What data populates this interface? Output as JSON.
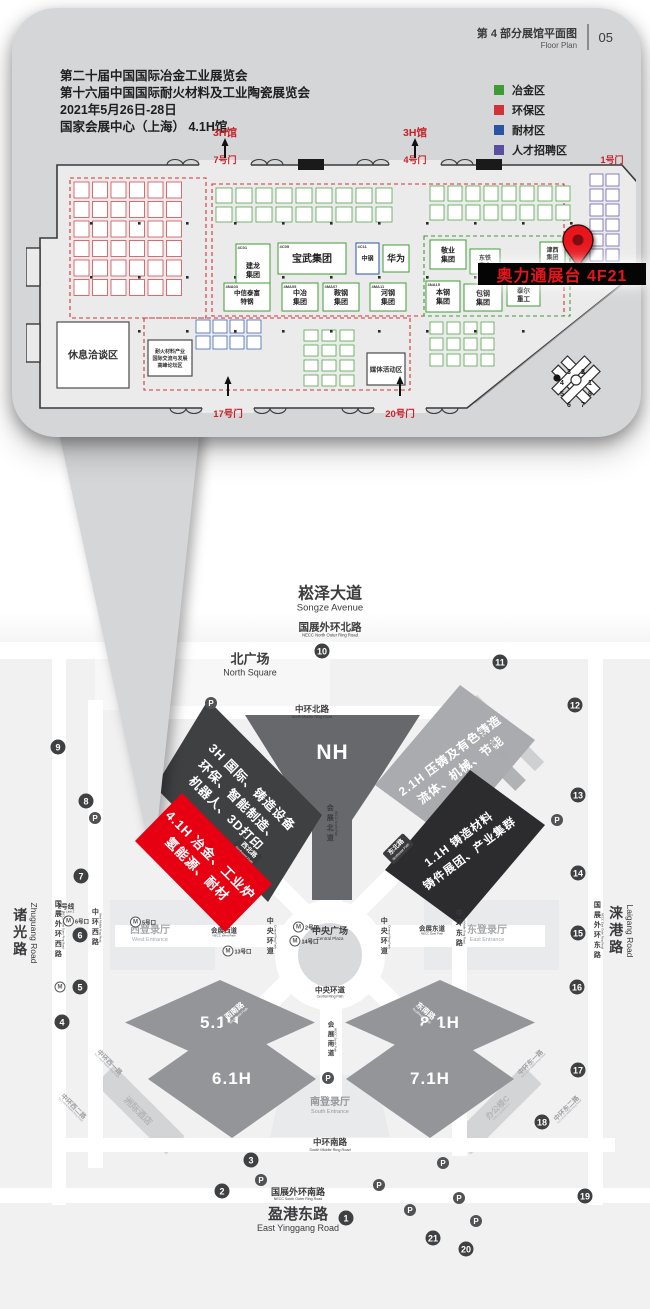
{
  "callout": {
    "header": {
      "title_zh": "第 4 部分展馆平面图",
      "title_en": "Floor Plan",
      "page_no": "05"
    },
    "info_lines": [
      "第二十届中国国际冶金工业展览会",
      "第十六届中国国际耐火材料及工业陶瓷展览会",
      "2021年5月26日-28日",
      "国家会展中心（上海） 4.1H馆"
    ],
    "legend": [
      {
        "label": "冶金区",
        "key": "green"
      },
      {
        "label": "环保区",
        "key": "red"
      },
      {
        "label": "耐材区",
        "key": "blue"
      },
      {
        "label": "人才招聘区",
        "key": "purple"
      }
    ],
    "zone_colors": {
      "green": "#3f9c35",
      "red": "#cf3339",
      "blue": "#2a55a5",
      "purple": "#5b4ea0"
    },
    "floorplan": {
      "marker_label": "奥力通展台 4F21",
      "compass_numbers": [
        "3",
        "2",
        "4",
        "1",
        "5",
        "8",
        "6",
        "7"
      ],
      "gates_top": [
        {
          "hall_label": "3H馆",
          "gate": "7号门",
          "x": 199
        },
        {
          "hall_label": "3H馆",
          "gate": "4号门",
          "x": 389
        },
        {
          "hall_label": "",
          "gate": "1号门",
          "x": 586,
          "plain": true
        }
      ],
      "gates_bottom": [
        {
          "gate": "17号门",
          "x": 202
        },
        {
          "gate": "20号门",
          "x": 374
        }
      ],
      "zones": [
        {
          "x": 44,
          "y": 52,
          "w": 136,
          "h": 140,
          "c": "red"
        },
        {
          "x": 186,
          "y": 58,
          "w": 352,
          "h": 132,
          "c": "red"
        },
        {
          "x": 118,
          "y": 192,
          "w": 266,
          "h": 72,
          "c": "red"
        },
        {
          "x": 398,
          "y": 110,
          "w": 146,
          "h": 80,
          "c": "green"
        }
      ],
      "grids": [
        {
          "x": 48,
          "y": 56,
          "cols": 6,
          "rows": 6,
          "cw": 15,
          "ch": 16,
          "g": 3.5,
          "c": "red"
        },
        {
          "x": 190,
          "y": 62,
          "cols": 9,
          "rows": 2,
          "cw": 16,
          "ch": 15,
          "g": 4,
          "c": "green"
        },
        {
          "x": 404,
          "y": 60,
          "cols": 8,
          "rows": 2,
          "cw": 14,
          "ch": 15,
          "g": 4,
          "c": "green"
        },
        {
          "x": 170,
          "y": 194,
          "cols": 4,
          "rows": 2,
          "cw": 14,
          "ch": 13,
          "g": 3,
          "c": "blue"
        },
        {
          "x": 278,
          "y": 204,
          "cols": 3,
          "rows": 4,
          "cw": 14,
          "ch": 11,
          "g": 4,
          "c": "green"
        },
        {
          "x": 404,
          "y": 196,
          "cols": 4,
          "rows": 3,
          "cw": 13,
          "ch": 12,
          "g": 4,
          "c": "green"
        },
        {
          "x": 564,
          "y": 48,
          "cols": 2,
          "rows": 6,
          "cw": 13,
          "ch": 12,
          "g": 3,
          "c": "purple"
        }
      ],
      "booths": [
        {
          "id": "4C01",
          "lines": [
            "建龙",
            "集团"
          ],
          "x": 210,
          "y": 118,
          "w": 34,
          "h": 52,
          "fs": 7,
          "c": "green"
        },
        {
          "id": "4C05",
          "lines": [
            "宝武集团"
          ],
          "x": 252,
          "y": 117,
          "w": 68,
          "h": 31,
          "fs": 10,
          "c": "green"
        },
        {
          "id": "4C11",
          "lines": [
            "中钢"
          ],
          "x": 330,
          "y": 117,
          "w": 23,
          "h": 31,
          "fs": 6,
          "c": "blue"
        },
        {
          "lines": [
            "华为"
          ],
          "x": 357,
          "y": 119,
          "w": 26,
          "h": 27,
          "fs": 9,
          "c": "green"
        },
        {
          "id": "4NA03",
          "lines": [
            "中信泰富",
            "特钢"
          ],
          "x": 198,
          "y": 157,
          "w": 46,
          "h": 28,
          "fs": 6.5,
          "c": "green"
        },
        {
          "id": "4MA05",
          "lines": [
            "中冶",
            "集团"
          ],
          "x": 256,
          "y": 157,
          "w": 36,
          "h": 28,
          "fs": 7,
          "c": "green"
        },
        {
          "id": "4MA07",
          "lines": [
            "鞍钢",
            "集团"
          ],
          "x": 297,
          "y": 157,
          "w": 36,
          "h": 28,
          "fs": 7,
          "c": "green"
        },
        {
          "id": "4MA11",
          "lines": [
            "河钢",
            "集团"
          ],
          "x": 344,
          "y": 157,
          "w": 36,
          "h": 28,
          "fs": 7,
          "c": "green"
        },
        {
          "lines": [
            "敬业",
            "集团"
          ],
          "x": 404,
          "y": 114,
          "w": 36,
          "h": 29,
          "fs": 7,
          "c": "green"
        },
        {
          "lines": [
            "东铁",
            "实业"
          ],
          "x": 444,
          "y": 123,
          "w": 30,
          "h": 25,
          "fs": 6,
          "c": "green"
        },
        {
          "lines": [
            "津西",
            "集团"
          ],
          "x": 514,
          "y": 116,
          "w": 25,
          "h": 23,
          "fs": 6,
          "c": "green"
        },
        {
          "id": "4NA15",
          "lines": [
            "本钢",
            "集团"
          ],
          "x": 400,
          "y": 155,
          "w": 34,
          "h": 31,
          "fs": 7,
          "c": "green"
        },
        {
          "lines": [
            "包钢",
            "集团"
          ],
          "x": 438,
          "y": 158,
          "w": 38,
          "h": 27,
          "fs": 7,
          "c": "green"
        },
        {
          "lines": [
            "泰尔",
            "重工"
          ],
          "x": 481,
          "y": 157,
          "w": 33,
          "h": 23,
          "fs": 6.5,
          "c": "green"
        }
      ],
      "areas": [
        {
          "lines": [
            "休息洽谈区"
          ],
          "x": 31,
          "y": 196,
          "w": 72,
          "h": 66,
          "fs": 10,
          "bold": true
        },
        {
          "lines": [
            "耐火材料产业",
            "国际交流与发展",
            "高峰论坛区"
          ],
          "x": 122,
          "y": 214,
          "w": 44,
          "h": 36,
          "fs": 5,
          "bold": true
        },
        {
          "lines": [
            "媒体活动区"
          ],
          "x": 341,
          "y": 227,
          "w": 38,
          "h": 32,
          "fs": 6.5,
          "bold": true
        }
      ]
    }
  },
  "map": {
    "parking_symbol": "P",
    "metro_symbol": "M",
    "halls": [
      {
        "id": "NH",
        "label": "NH"
      },
      {
        "id": "3H",
        "lines": [
          "3H 国际、铸造设备",
          "环保、智能制造、",
          "机器人、3D打印"
        ]
      },
      {
        "id": "2.1H",
        "lines": [
          "2.1H 压铸及有色铸造",
          "流体、机械、节能"
        ]
      },
      {
        "id": "1.1H",
        "lines": [
          "1.1H 铸造材料",
          "铸件展团、产业集群"
        ]
      },
      {
        "id": "4.1H",
        "lines": [
          "4.1H 冶金、工业炉",
          "氢能源、耐材"
        ],
        "highlight": true
      },
      {
        "id": "5.1H",
        "label": "5.1H"
      },
      {
        "id": "6.1H",
        "label": "6.1H"
      },
      {
        "id": "7.1H",
        "label": "7.1H"
      },
      {
        "id": "8.1H",
        "label": "8.1H"
      }
    ],
    "labels": [
      {
        "zh": "崧泽大道",
        "en": "Songze Avenue",
        "x": 330,
        "y": 600,
        "size": 16,
        "esize": 9.5
      },
      {
        "zh": "国展外环北路",
        "en": "NECC North Outer Ring Road",
        "x": 330,
        "y": 630,
        "size": 10.5,
        "esize": 4.2
      },
      {
        "zh": "北广场",
        "en": "North Square",
        "x": 250,
        "y": 665,
        "size": 13,
        "esize": 9
      },
      {
        "zh": "中环北路",
        "en": "North Middle Ring Road",
        "x": 312,
        "y": 712,
        "size": 8.5,
        "esize": 3.8
      },
      {
        "zh": "会展北道",
        "en": "NECC North Path",
        "x": 331,
        "y": 824,
        "size": 7,
        "esize": 3.2,
        "vert": 1
      },
      {
        "zh": "中央广场",
        "en": "Central Plaza",
        "x": 330,
        "y": 934,
        "size": 9,
        "esize": 4.5
      },
      {
        "zh": "中央环道",
        "en": "Central Ring Path",
        "x": 271,
        "y": 937,
        "size": 7,
        "esize": 3,
        "vert": 1
      },
      {
        "zh": "中央环道",
        "en": "Central Ring Path",
        "x": 385,
        "y": 937,
        "size": 7,
        "esize": 3,
        "vert": 1
      },
      {
        "zh": "中央环道",
        "en": "Central Ring Path",
        "x": 330,
        "y": 993,
        "size": 7.5,
        "esize": 3.4
      },
      {
        "zh": "西登录厅",
        "en": "West Entrance",
        "x": 150,
        "y": 934,
        "size": 10,
        "esize": 5.5,
        "color": "#a6a8aa"
      },
      {
        "zh": "会展西道",
        "en": "NECC West Path",
        "x": 224,
        "y": 933,
        "size": 6.5,
        "esize": 3
      },
      {
        "zh": "东登录厅",
        "en": "East Entrance",
        "x": 487,
        "y": 934,
        "size": 10,
        "esize": 5.5,
        "color": "#a6a8aa"
      },
      {
        "zh": "会展东道",
        "en": "NECC East Path",
        "x": 432,
        "y": 931,
        "size": 6.5,
        "esize": 3
      },
      {
        "zh": "南登录厅",
        "en": "South Entrance",
        "x": 330,
        "y": 1106,
        "size": 10,
        "esize": 5.5,
        "color": "#96989b"
      },
      {
        "zh": "会展南道",
        "en": "NECC South Path",
        "x": 331,
        "y": 1040,
        "size": 6.5,
        "esize": 3,
        "vert": 1
      },
      {
        "zh": "中环南路",
        "en": "South Middle Ring Road",
        "x": 330,
        "y": 1145,
        "size": 8.5,
        "esize": 3.8
      },
      {
        "zh": "国展外环南路",
        "en": "NECC South Outer Ring Road",
        "x": 298,
        "y": 1194,
        "size": 9,
        "esize": 3.6
      },
      {
        "zh": "盈港东路",
        "en": "East Yinggang Road",
        "x": 298,
        "y": 1220,
        "size": 15,
        "esize": 9
      },
      {
        "zh": "诸光路",
        "en": "Zhuguang Road",
        "x": 25,
        "y": 933,
        "size": 14,
        "esize": 8.5,
        "vert": 1
      },
      {
        "zh": "国展外环西路",
        "en": "NECC West Outer Ring Road",
        "x": 59,
        "y": 930,
        "size": 7,
        "esize": 2.8,
        "vert": 1
      },
      {
        "zh": "中环西路",
        "en": "West Middle Ring Road",
        "x": 96,
        "y": 928,
        "size": 7,
        "esize": 2.8,
        "vert": 1
      },
      {
        "zh": "涞港路",
        "en": "Laigang Road",
        "x": 621,
        "y": 931,
        "size": 14,
        "esize": 8.5,
        "vert": 1
      },
      {
        "zh": "国展外环东路",
        "en": "NECC East Outer Ring Road",
        "x": 598,
        "y": 931,
        "size": 7,
        "esize": 2.8,
        "vert": 1
      },
      {
        "zh": "中环东路",
        "en": "East Middle Ring Road",
        "x": 460,
        "y": 929,
        "size": 7,
        "esize": 2.8,
        "vert": 1
      },
      {
        "zh": "西南路",
        "en": "Southwest Path",
        "x": 236,
        "y": 1013,
        "size": 7.5,
        "esize": 3.4,
        "rot": -40,
        "color": "#ffffff"
      },
      {
        "zh": "东南路",
        "en": "Southeast Path",
        "x": 424,
        "y": 1013,
        "size": 7.5,
        "esize": 3.4,
        "rot": 40,
        "color": "#ffffff"
      },
      {
        "zh": "洲际酒店",
        "en": "",
        "x": 138,
        "y": 1111,
        "size": 9,
        "rot": 45,
        "color": "#b4b5b7"
      },
      {
        "zh": "中环西一路",
        "en": "No.1 West Middle Ring Road",
        "x": 108,
        "y": 1064,
        "size": 6.5,
        "esize": 2.6,
        "rot": 45,
        "color": "#9fa1a4"
      },
      {
        "zh": "中环西二路",
        "en": "No.2 West Middle Ring Road",
        "x": 72,
        "y": 1108,
        "size": 6.5,
        "esize": 2.6,
        "rot": 45,
        "color": "#9fa1a4"
      },
      {
        "zh": "办公楼C",
        "en": "Office Building C",
        "x": 499,
        "y": 1109,
        "size": 8,
        "esize": 3.2,
        "rot": -45,
        "color": "#b4b5b7"
      },
      {
        "zh": "中环东一路",
        "en": "No.1 East Middle Ring Road",
        "x": 532,
        "y": 1064,
        "size": 6.5,
        "esize": 2.6,
        "rot": -45,
        "color": "#9fa1a4"
      },
      {
        "zh": "中环东二路",
        "en": "No.2 East Middle Ring Road",
        "x": 568,
        "y": 1110,
        "size": 6.5,
        "esize": 2.6,
        "rot": -45,
        "color": "#9fa1a4"
      },
      {
        "zh": "办公楼二期",
        "en": "",
        "x": 492,
        "y": 744,
        "size": 7.5,
        "rot": 45,
        "color": "#a8aaac"
      },
      {
        "zh": "2号线",
        "en": "Metro Line 2",
        "x": 66,
        "y": 909,
        "size": 6.5,
        "esize": 3
      }
    ],
    "dark_tags": [
      {
        "zh": "西北路",
        "en": "Northwest Path",
        "x": 247,
        "y": 852,
        "rot": 45
      },
      {
        "zh": "东北路",
        "en": "Northeast Path",
        "x": 398,
        "y": 849,
        "rot": -45
      }
    ],
    "gates": [
      {
        "n": "1",
        "x": 346,
        "y": 1218
      },
      {
        "n": "2",
        "x": 222,
        "y": 1191
      },
      {
        "n": "3",
        "x": 251,
        "y": 1160
      },
      {
        "n": "4",
        "x": 62,
        "y": 1022
      },
      {
        "n": "5",
        "x": 80,
        "y": 987
      },
      {
        "n": "6",
        "x": 80,
        "y": 935
      },
      {
        "n": "7",
        "x": 81,
        "y": 876
      },
      {
        "n": "8",
        "x": 86,
        "y": 801
      },
      {
        "n": "9",
        "x": 58,
        "y": 747
      },
      {
        "n": "10",
        "x": 322,
        "y": 651
      },
      {
        "n": "11",
        "x": 500,
        "y": 662
      },
      {
        "n": "12",
        "x": 575,
        "y": 705
      },
      {
        "n": "13",
        "x": 578,
        "y": 795
      },
      {
        "n": "14",
        "x": 578,
        "y": 873
      },
      {
        "n": "15",
        "x": 578,
        "y": 933
      },
      {
        "n": "16",
        "x": 577,
        "y": 987
      },
      {
        "n": "17",
        "x": 578,
        "y": 1070
      },
      {
        "n": "18",
        "x": 542,
        "y": 1122
      },
      {
        "n": "19",
        "x": 585,
        "y": 1196
      },
      {
        "n": "20",
        "x": 466,
        "y": 1249
      },
      {
        "n": "21",
        "x": 433,
        "y": 1238
      }
    ],
    "parking": [
      {
        "x": 211,
        "y": 703
      },
      {
        "x": 95,
        "y": 818
      },
      {
        "x": 557,
        "y": 820
      },
      {
        "x": 328,
        "y": 1078
      },
      {
        "x": 261,
        "y": 1180
      },
      {
        "x": 379,
        "y": 1185
      },
      {
        "x": 410,
        "y": 1210
      },
      {
        "x": 443,
        "y": 1163
      },
      {
        "x": 459,
        "y": 1198
      },
      {
        "x": 476,
        "y": 1221
      }
    ],
    "metro_exits": [
      {
        "label": "6号口",
        "x": 76,
        "y": 921
      },
      {
        "label": "5号口",
        "x": 143,
        "y": 922
      },
      {
        "label": "13号口",
        "x": 237,
        "y": 951
      },
      {
        "label": "2号口",
        "x": 306,
        "y": 927
      },
      {
        "label": "14号口",
        "x": 304,
        "y": 941
      },
      {
        "label": "",
        "x": 60,
        "y": 987
      }
    ]
  }
}
